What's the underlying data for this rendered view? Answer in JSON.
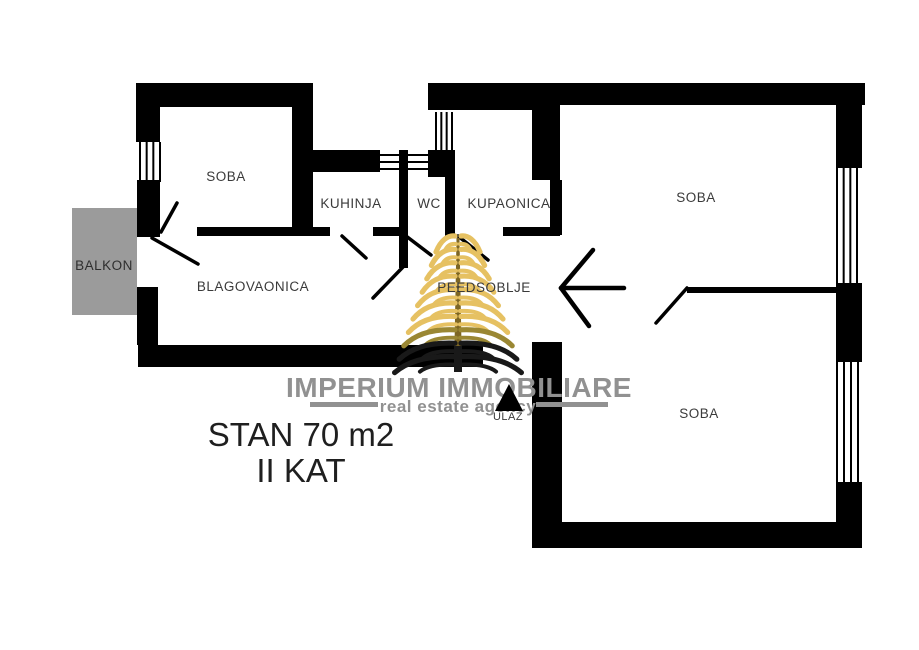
{
  "canvas": {
    "width": 919,
    "height": 650,
    "background": "#ffffff"
  },
  "colors": {
    "wall": "#000000",
    "label": "#3a3a3a",
    "balcony_fill": "#9b9b9b",
    "balcony_label": "#2e2e2e",
    "annotation": "#1f1f1f",
    "watermark_gray": "#919191",
    "gold": "#e6c162",
    "gold_dark": "#9a8733",
    "frond_dark": "#191919",
    "trunk": "#7d6624"
  },
  "room_labels": [
    {
      "id": "soba-top-left",
      "text": "SOBA",
      "x": 226,
      "y": 181,
      "size": 13.5
    },
    {
      "id": "kuhinja",
      "text": "KUHINJA",
      "x": 351,
      "y": 208,
      "size": 13.5
    },
    {
      "id": "wc",
      "text": "WC",
      "x": 429,
      "y": 208,
      "size": 13.5
    },
    {
      "id": "kupaonica",
      "text": "KUPAONICA",
      "x": 509,
      "y": 208,
      "size": 13.5
    },
    {
      "id": "blagovaonica",
      "text": "BLAGOVAONICA",
      "x": 253,
      "y": 291,
      "size": 13.5
    },
    {
      "id": "predsoblje",
      "text": "PEEDSOBLJE",
      "x": 484,
      "y": 292,
      "size": 13.5
    },
    {
      "id": "soba-top-right",
      "text": "SOBA",
      "x": 696,
      "y": 202,
      "size": 13.5
    },
    {
      "id": "soba-bottom-right",
      "text": "SOBA",
      "x": 699,
      "y": 418,
      "size": 13.5
    },
    {
      "id": "balkon",
      "text": "BALKON",
      "x": 104,
      "y": 270,
      "size": 13.5
    }
  ],
  "plan": {
    "balcony": {
      "x": 72,
      "y": 208,
      "w": 65,
      "h": 107
    },
    "walls": [
      [
        136,
        83,
        177,
        24
      ],
      [
        292,
        107,
        21,
        129
      ],
      [
        136,
        83,
        24,
        59
      ],
      [
        137,
        180,
        23,
        57
      ],
      [
        137,
        287,
        21,
        58
      ],
      [
        138,
        345,
        345,
        22
      ],
      [
        313,
        150,
        67,
        22
      ],
      [
        428,
        150,
        27,
        27
      ],
      [
        428,
        83,
        132,
        27
      ],
      [
        550,
        83,
        315,
        22
      ],
      [
        399,
        150,
        9,
        118
      ],
      [
        445,
        177,
        10,
        59
      ],
      [
        532,
        107,
        28,
        73
      ],
      [
        550,
        180,
        12,
        55
      ],
      [
        503,
        227,
        57,
        9
      ],
      [
        197,
        227,
        133,
        9
      ],
      [
        373,
        227,
        34,
        9
      ],
      [
        687,
        287,
        150,
        6
      ],
      [
        836,
        83,
        26,
        85
      ],
      [
        836,
        283,
        26,
        79
      ],
      [
        836,
        482,
        26,
        66
      ],
      [
        532,
        522,
        328,
        26
      ],
      [
        532,
        342,
        30,
        180
      ]
    ],
    "windows": [
      {
        "r": [
          140,
          142,
          20,
          40
        ],
        "o": "v",
        "n": 4
      },
      {
        "r": [
          436,
          112,
          16,
          38
        ],
        "o": "v",
        "n": 4
      },
      {
        "r": [
          378,
          155,
          50,
          14
        ],
        "o": "h",
        "n": 3
      },
      {
        "r": [
          837,
          168,
          20,
          115
        ],
        "o": "v",
        "n": 4
      },
      {
        "r": [
          837,
          362,
          21,
          120
        ],
        "o": "v",
        "n": 4
      }
    ],
    "doors": [
      [
        161,
        232,
        177,
        203
      ],
      [
        152,
        238,
        198,
        264
      ],
      [
        342,
        236,
        366,
        258
      ],
      [
        406,
        236,
        431,
        255
      ],
      [
        403,
        267,
        373,
        298
      ],
      [
        458,
        236,
        488,
        260
      ],
      [
        687,
        288,
        656,
        323
      ]
    ],
    "door_width": 3.5,
    "arrow": {
      "shaft": [
        624,
        288,
        561,
        288
      ],
      "head": [
        [
          561,
          288,
          593,
          250
        ],
        [
          561,
          288,
          589,
          326
        ]
      ],
      "width": 4.5
    },
    "entrance": {
      "triangle": [
        [
          509,
          384
        ],
        [
          495,
          411
        ],
        [
          523,
          411
        ]
      ],
      "label": "ULAZ",
      "x": 508,
      "y": 420,
      "size": 11
    }
  },
  "annotation": {
    "line1": "STAN 70 m2",
    "line2": "II KAT",
    "x": 301,
    "y1": 446,
    "y2": 482,
    "size": 33
  },
  "watermark": {
    "title": "IMPERIUM IMMOBILIARE",
    "subtitle": "real estate agency",
    "title_x": 459,
    "title_y": 397,
    "title_size": 28,
    "sub_x": 458,
    "sub_y": 412,
    "sub_size": 17,
    "rules": [
      [
        310,
        402,
        68,
        5
      ],
      [
        536,
        402,
        72,
        5
      ]
    ],
    "tree": {
      "cx": 458,
      "apex": 238,
      "bottom": 372,
      "rows": 10,
      "first_y": 247,
      "gap": 13.4,
      "base_reach": 22,
      "reach_step": 4.6,
      "frond_w": 5.2,
      "inner_w": 4
    }
  }
}
